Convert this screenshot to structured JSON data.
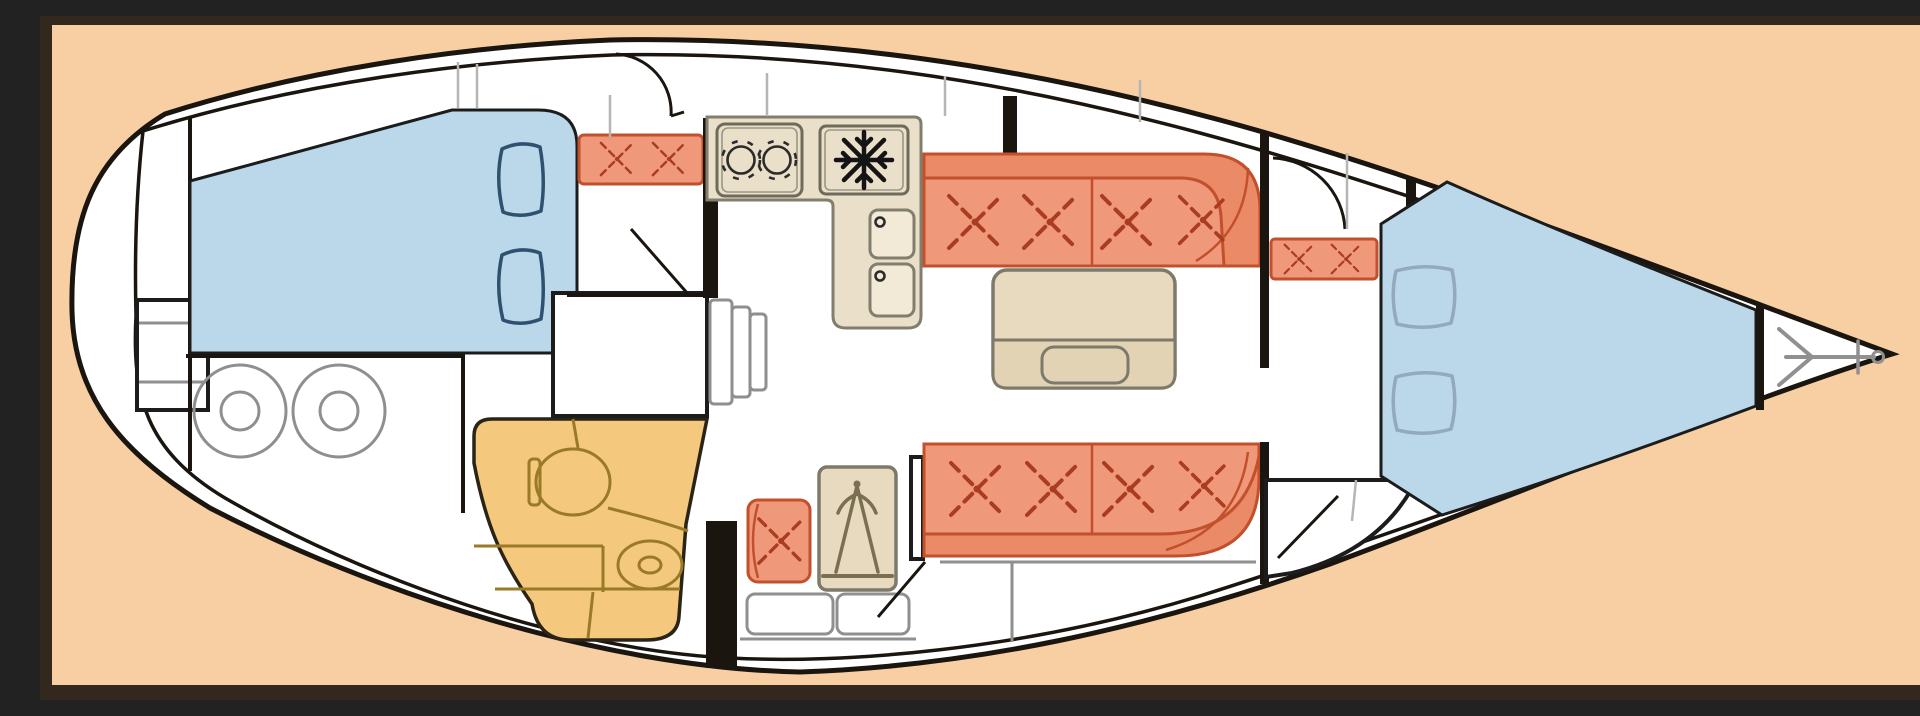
{
  "page": {
    "title": "Sailboat interior layout plan, bow pointing right",
    "type": "boat-floor-plan"
  },
  "colors": {
    "frame": "#33281e",
    "background": "#f7cfa3",
    "hull": "#ffffff",
    "outline": "#1a150f",
    "berth": "#bad8ea",
    "pillow-dark": "#2f506e",
    "pillow-light": "#93a9bd",
    "cushion": "#f0997a",
    "cushion-dark": "#ea8a66",
    "cushion-line": "#c2502c",
    "stitch": "#aa3c22",
    "counter": "#eadfc8",
    "counter-soft": "#f2ead6",
    "counter-line": "#827e6d",
    "appl-line": "#6f6b5b",
    "head": "#f4c87d",
    "head-line": "#9a7a28",
    "table": "#e7dabe",
    "table-low": "#e2d3b4",
    "table-line": "#7d7a6c",
    "gray-line": "#8f8f8f",
    "deck-line": "#b5b5b5",
    "anchor": "#909090"
  },
  "rooms": {
    "stern": {
      "label": "Stern with swim ladder",
      "ladder_steps": 2
    },
    "aft_cabin": {
      "label": "Aft double cabin",
      "pillows": 2,
      "seat_stitches": 2,
      "door": "arc"
    },
    "aft_storage": {
      "label": "Aft compartment",
      "round_hatches": 2
    },
    "head": {
      "label": "Head / bathroom",
      "fixtures": [
        "toilet",
        "washbasin",
        "counter"
      ]
    },
    "companionway": {
      "label": "Companionway",
      "steps": 3
    },
    "galley": {
      "label": "Galley",
      "stove_burners": 2,
      "fridge_symbol": "snowflake",
      "sinks": 2
    },
    "nav_station": {
      "label": "Navigation station",
      "seat_stitches": 1,
      "chart_table_symbol": "drafting-dividers"
    },
    "salon": {
      "label": "Salon",
      "port_settee_stitches": 4,
      "starboard_settee_stitches": 4,
      "table": "folding leaf table"
    },
    "forward_entry": {
      "label": "Forward cabin entry",
      "seat_stitches": 2,
      "door": "arc"
    },
    "forward_cabin": {
      "label": "Forward V-berth cabin",
      "pillows": 2
    },
    "forepeak": {
      "label": "Anchor locker",
      "symbol": "anchor"
    }
  }
}
